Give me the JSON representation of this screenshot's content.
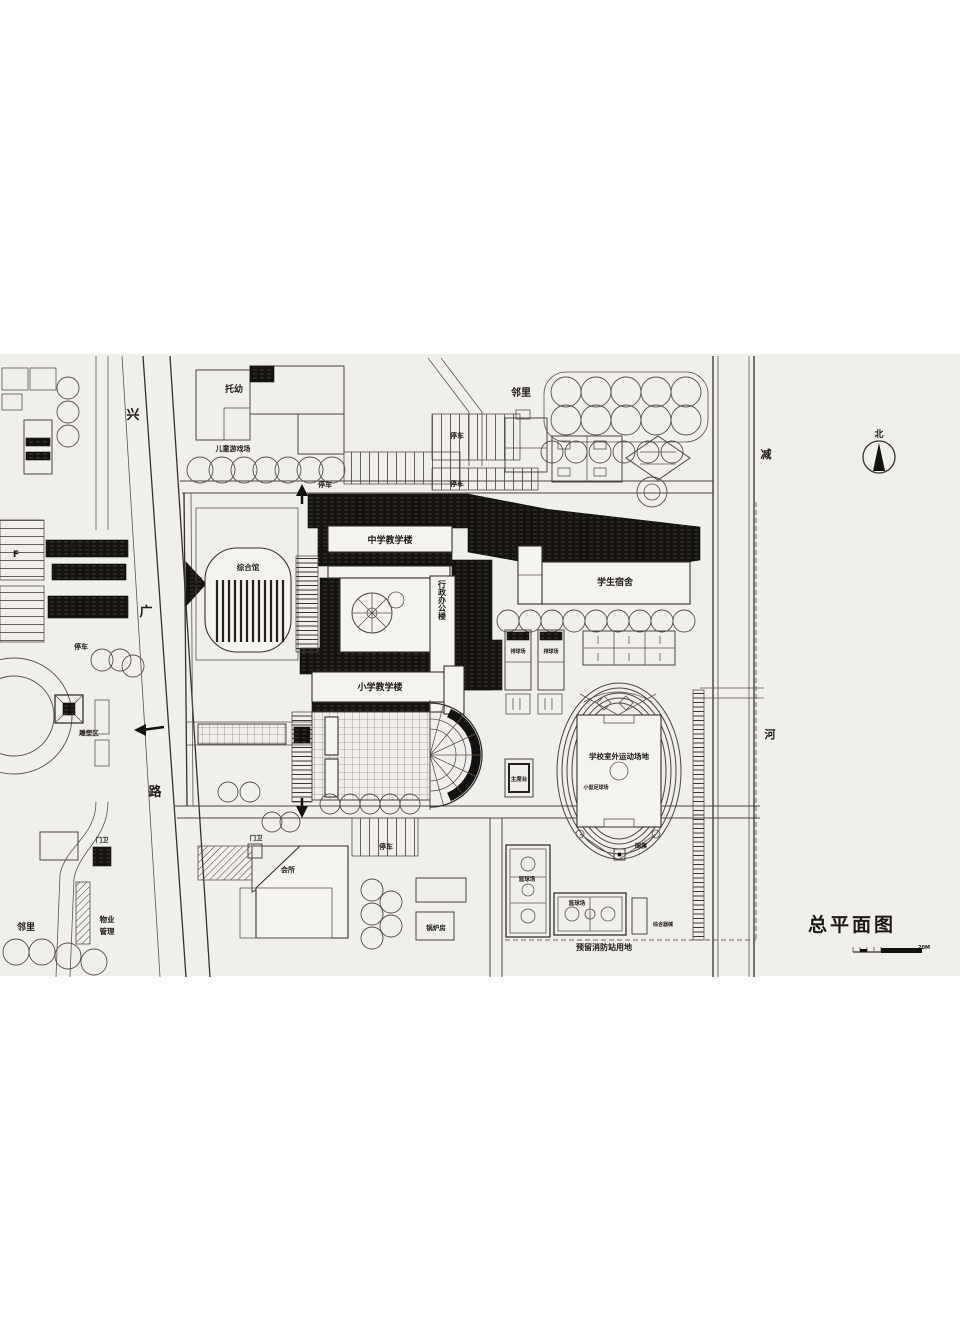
{
  "title": "总平面图",
  "north_label": "北",
  "scale_label": "20M",
  "roads": {
    "west_chars": [
      "兴",
      "广",
      "路"
    ],
    "east_chars": [
      "减",
      "河"
    ]
  },
  "campus": {
    "gym": "综合馆",
    "middle_school_building": "中学教学楼",
    "admin_building": "行政办公楼",
    "primary_school_building": "小学教学楼",
    "dormitory": "学生宿舍",
    "entrance": "入口",
    "rostrum": "主席台",
    "sports_ground": "学校室外运动场地",
    "mini_soccer_field": "小型足球场",
    "national_flag": "国旗",
    "basketball_court": "篮球场",
    "volleyball_court": "排球场",
    "apparatus_area": "综合器械",
    "fire_station_reserve": "预留消防站用地"
  },
  "surroundings": {
    "nursery": "托幼",
    "children_playground": "儿童游戏场",
    "neighborhood": "邻里",
    "parking": "停车",
    "clubhouse": "会所",
    "gatehouse": "门卫",
    "property_management_line1": "物业",
    "property_management_line2": "管理",
    "boiler_room": "锅炉房",
    "sculpture_area": "雕塑区",
    "f_mark": "F"
  },
  "colors": {
    "paper": "#f1efeb",
    "ink": "#141210"
  }
}
